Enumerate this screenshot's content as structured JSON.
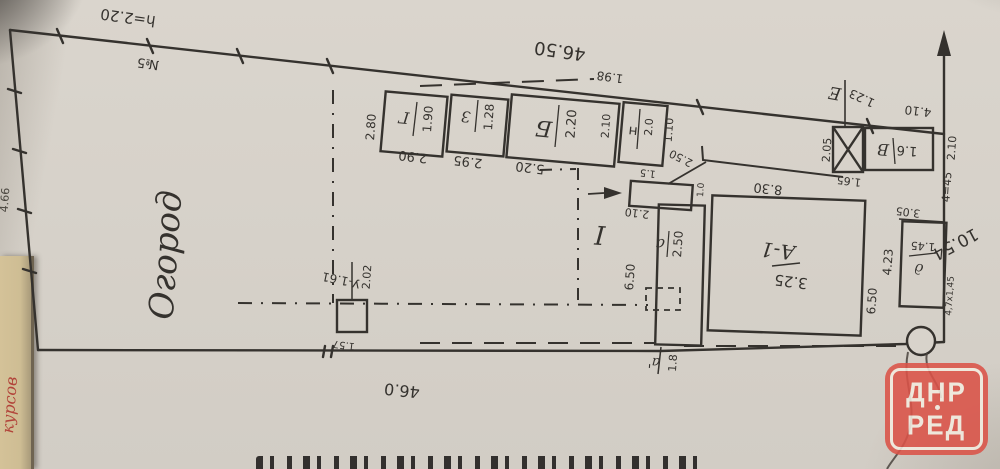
{
  "document": {
    "type": "scanned hand-drawn land plot plan, rotated 180 degrees",
    "watermark": {
      "line1": "ДНР",
      "line2": "РЕД"
    },
    "side_red_note": "курсов",
    "left_edge_note": "4.66"
  },
  "colors": {
    "ink": "#35322e",
    "paper": "#d8d3cb",
    "watermark_red": "#db5348",
    "side_note_red": "#b2443a"
  },
  "texts": {
    "top_note": "h=2.20",
    "plot_no": "№5",
    "top_length": "46.50",
    "seg_198": "1.98",
    "row_width": "2.80",
    "shed_g_label": "Г",
    "shed_g_size": "1.90",
    "shed_g_width": "2.90",
    "shed_z_label": "З",
    "shed_z_size": "1.28",
    "shed_z_width": "2.95",
    "shed_b_label": "Б",
    "shed_b_size": "2.20",
    "shed_b_width": "5.20",
    "shed_n_label": "н",
    "shed_n_size": "2.0",
    "gap_210": "2.10",
    "gap_110": "1.10",
    "e_label": "Е",
    "e_size": "1.23",
    "v_label": "В",
    "v_size": "1.6",
    "v_left": "2.05",
    "v_below": "1.65",
    "v_top": "4.10",
    "chain_210": "2.10",
    "chain_445": "4=45",
    "chain_305": "3.05",
    "right_length": "10.54",
    "d_left": "4.23",
    "house_650": "6.50",
    "d_size": "1.45",
    "d_label": "д",
    "d_note": "4,7х1,45",
    "house_label": "А-1",
    "house_height": "3.25",
    "house_width": "8.30",
    "annex_210": "2.10",
    "annex_label": "а",
    "annex_size": "2.50",
    "annex_650": "6.50",
    "porch_15": "1.5",
    "diag_250": "2.50",
    "porch_10": "1.0",
    "aprime_label": "а'",
    "aprime_size": "1.8",
    "section_mark": "I",
    "toilet_label": "У-1.61",
    "toilet_dist": "2.02",
    "toilet_157": "1.57",
    "garden": "Огород",
    "bottom_length": "46.0"
  }
}
